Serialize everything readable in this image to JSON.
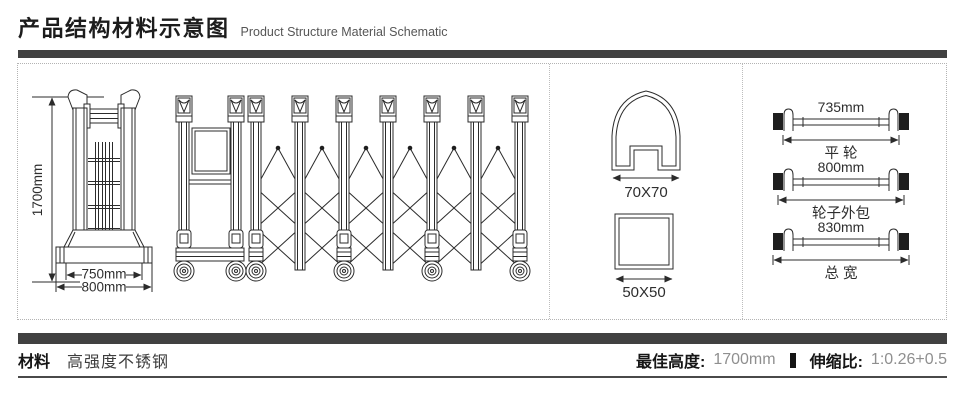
{
  "header": {
    "title_zh": "产品结构材料示意图",
    "title_en": "Product Structure Material Schematic"
  },
  "colors": {
    "divider_bar": "#414141",
    "line_art": "#2b2b2b",
    "muted_value_text": "#8f8f8f",
    "dotted_border": "#b3b3b3"
  },
  "diagram": {
    "gate": {
      "height_dim": "1700mm",
      "base_inner_dim": "750mm",
      "base_outer_dim": "800mm"
    },
    "profiles": {
      "rail_section": "70X70",
      "post_section": "50X50"
    },
    "axles": [
      {
        "value": "735mm",
        "name": "平 轮"
      },
      {
        "value": "800mm",
        "name": "轮子外包"
      },
      {
        "value": "830mm",
        "name": "总 宽"
      }
    ]
  },
  "footer": {
    "material_label": "材料",
    "material_value": "高强度不锈钢",
    "best_height_label": "最佳高度:",
    "best_height_value": "1700mm",
    "ratio_label": "伸缩比:",
    "ratio_value": "1:0.26+0.5"
  }
}
